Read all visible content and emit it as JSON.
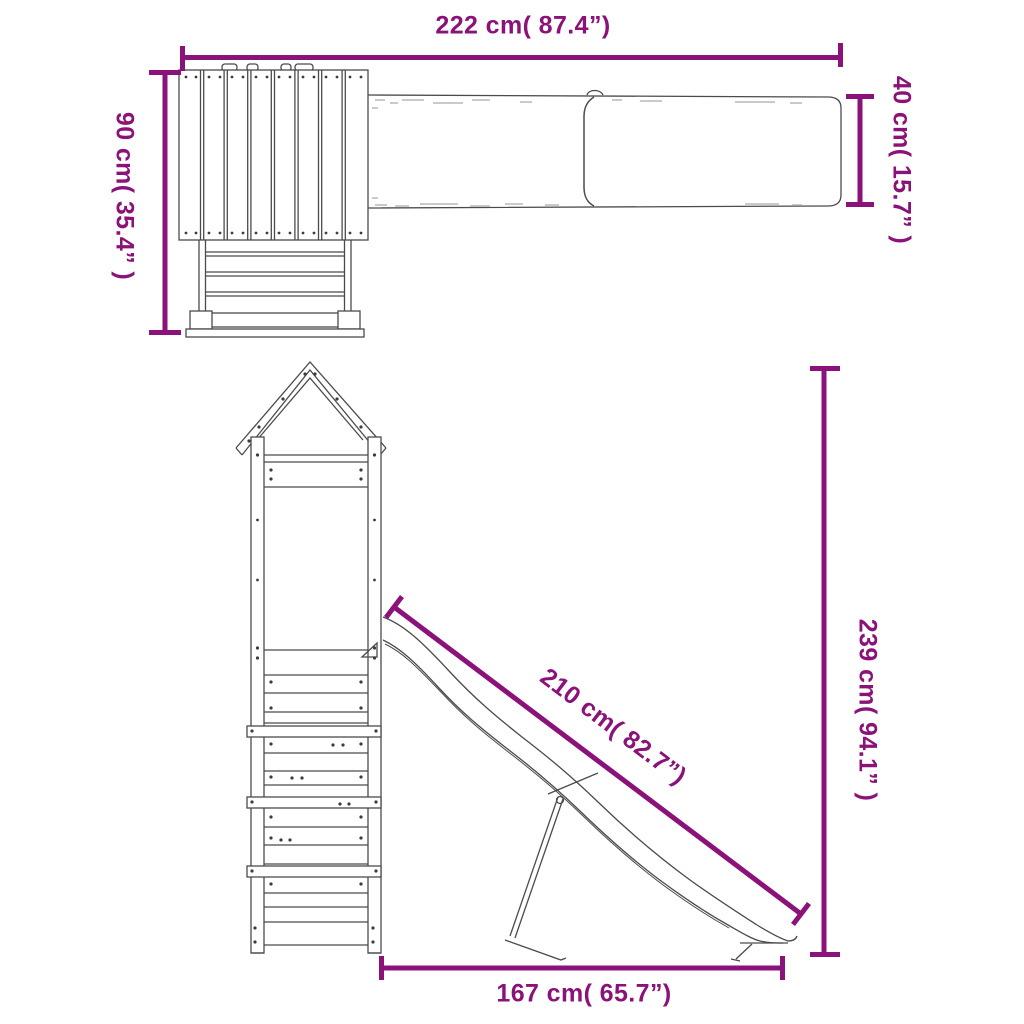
{
  "accent_color": "#8A1278",
  "artwork_line_color": "#4b4b4b",
  "background_color": "#ffffff",
  "dimensions": {
    "overall_width_top": {
      "label": "222 cm( 87.4”)",
      "cm": 222,
      "inches": 87.4
    },
    "depth_left": {
      "label": "90 cm( 35.4” )",
      "cm": 90,
      "inches": 35.4
    },
    "slide_width_right": {
      "label": "40 cm( 15.7” )",
      "cm": 40,
      "inches": 15.7
    },
    "slide_length": {
      "label": "210 cm( 82.7”)",
      "cm": 210,
      "inches": 82.7
    },
    "overall_height": {
      "label": "239 cm( 94.1” )",
      "cm": 239,
      "inches": 94.1
    },
    "base_width_bottom": {
      "label": "167 cm( 65.7”)",
      "cm": 167,
      "inches": 65.7
    }
  }
}
